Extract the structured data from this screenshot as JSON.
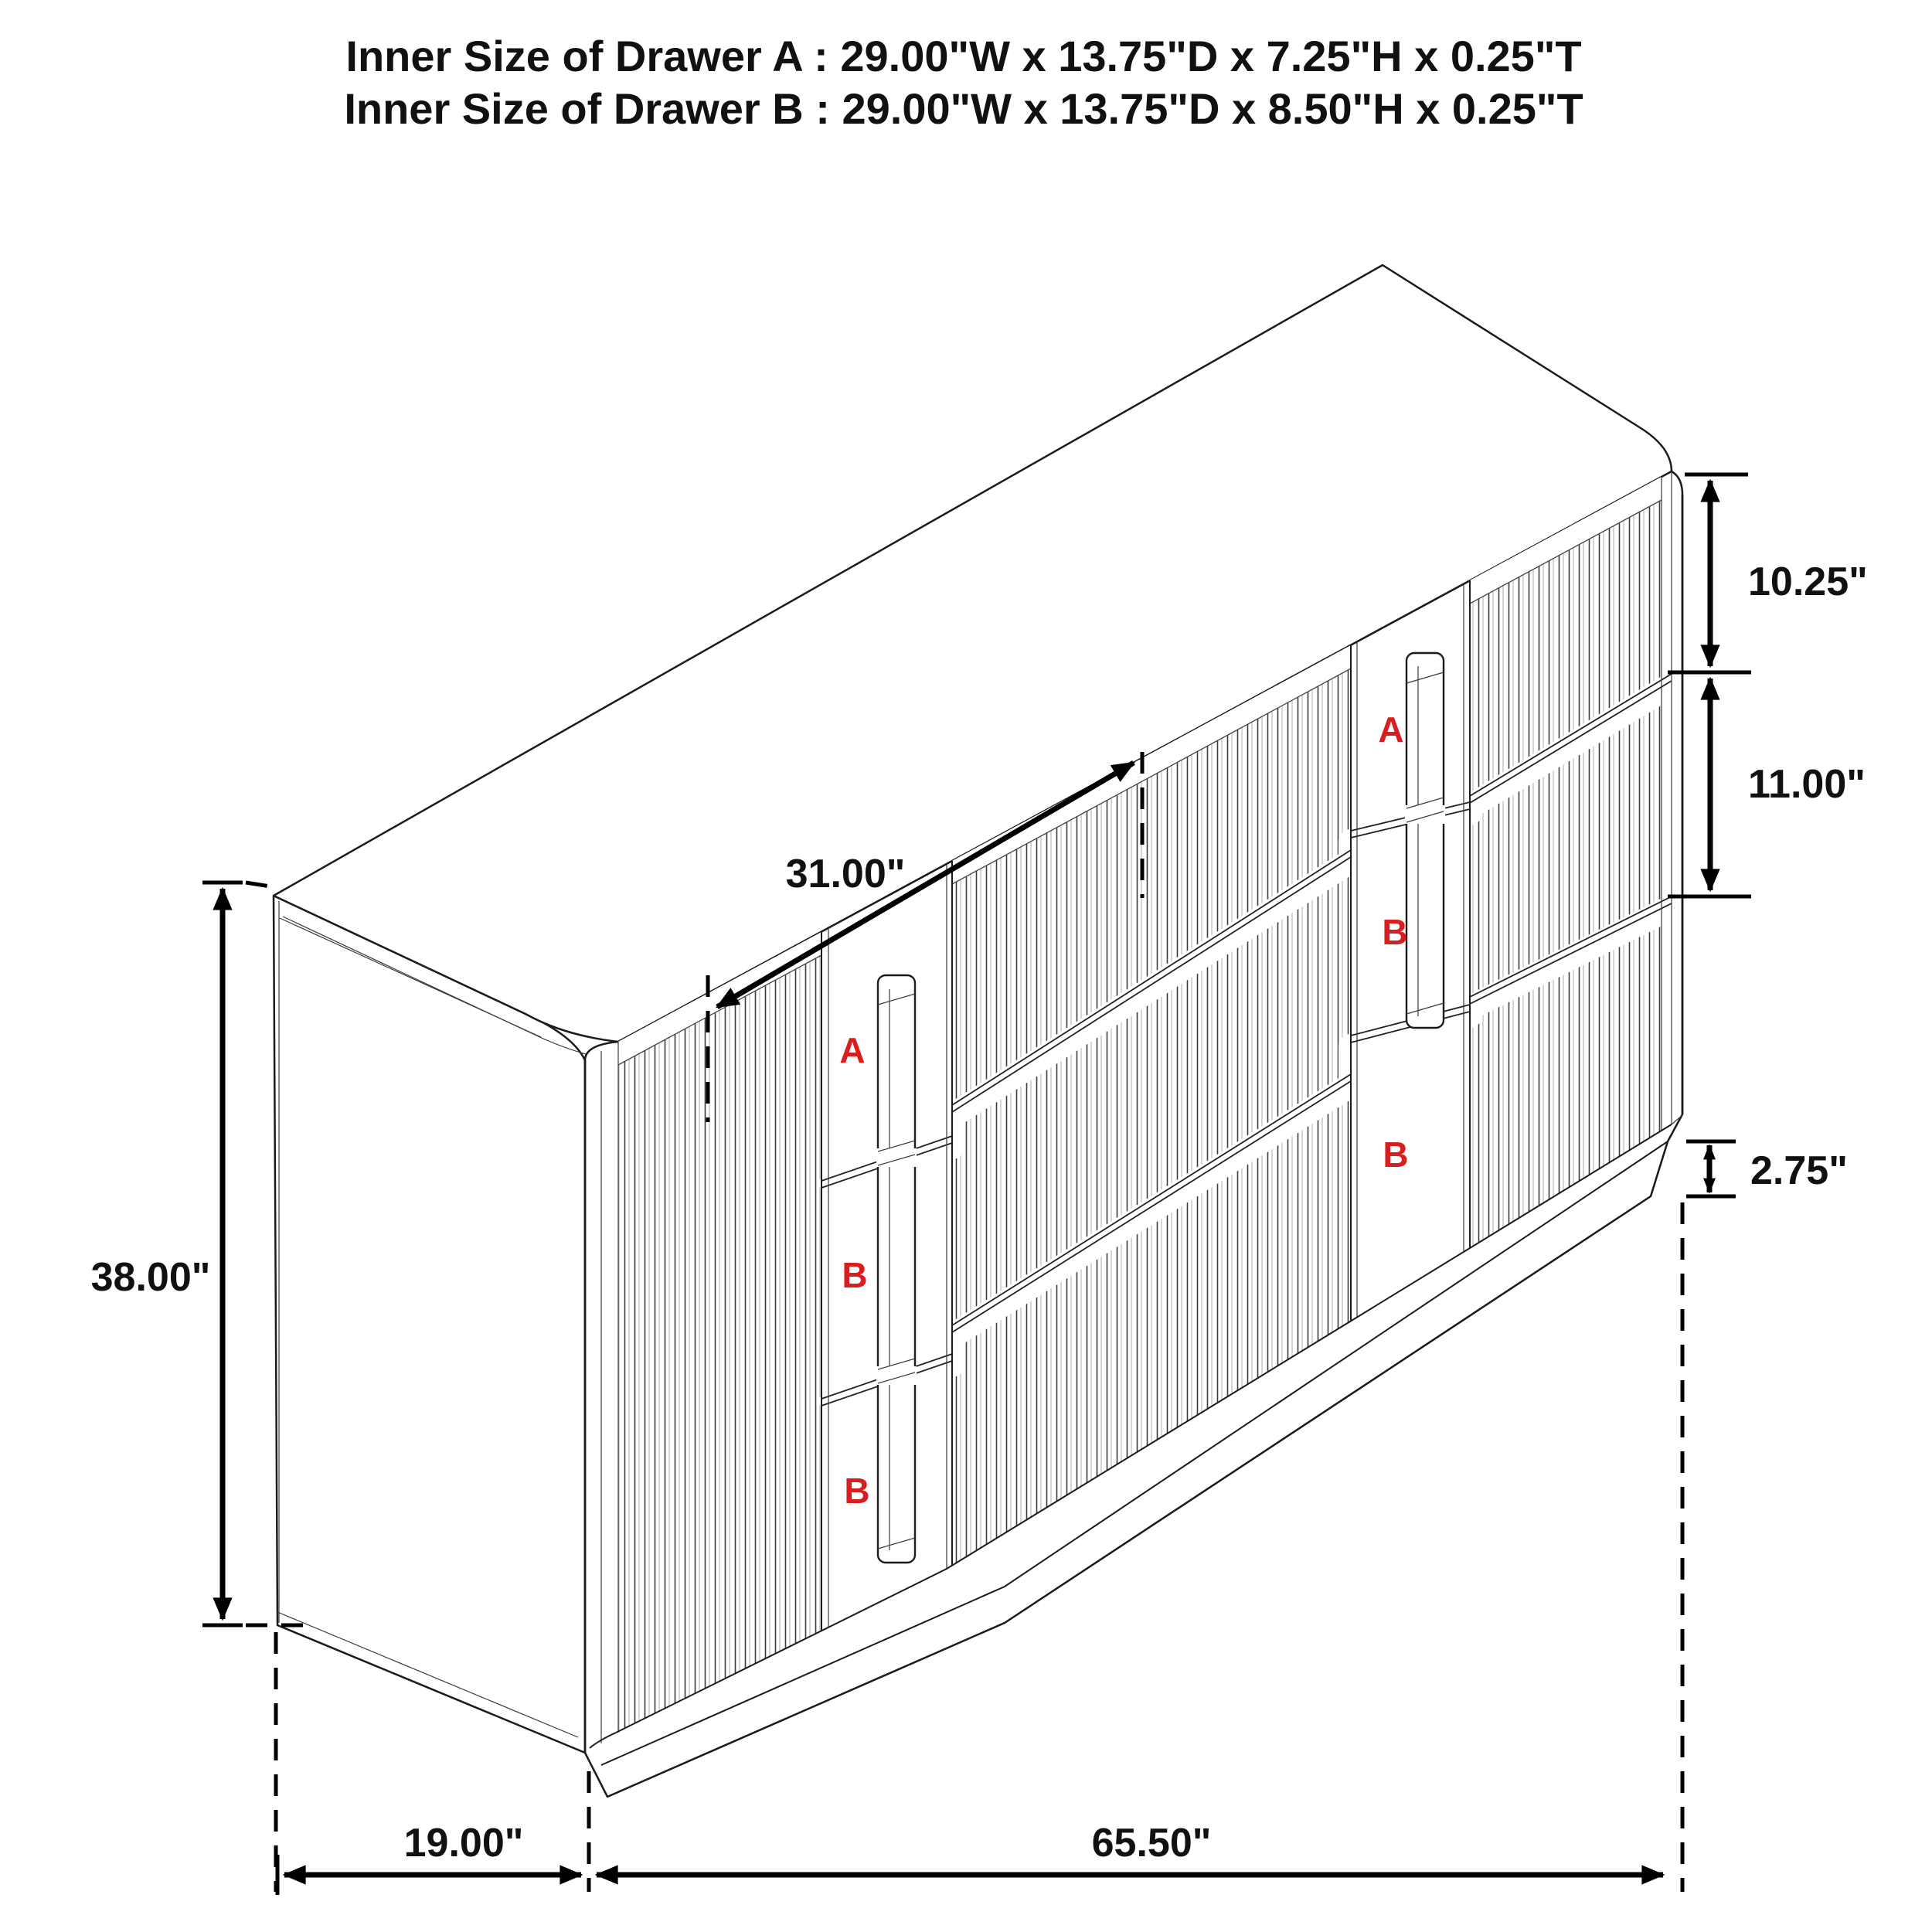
{
  "title": {
    "line1": "Inner Size of Drawer A : 29.00\"W x 13.75\"D x 7.25\"H x 0.25\"T",
    "line2": "Inner Size of Drawer B : 29.00\"W x 13.75\"D x 8.50\"H x 0.25\"T"
  },
  "dimensions": {
    "drawer_a_height": "10.25\"",
    "drawer_b_height": "11.00\"",
    "base_height": "2.75\"",
    "overall_height": "38.00\"",
    "middle_drawer_width": "31.00\"",
    "depth": "19.00\"",
    "overall_width": "65.50\""
  },
  "drawer_labels": {
    "left_bank": [
      "A",
      "B",
      "B"
    ],
    "right_bank": [
      "A",
      "B",
      "B"
    ]
  },
  "colors": {
    "line": "#1b1b1b",
    "label_red": "#d81e1e"
  }
}
